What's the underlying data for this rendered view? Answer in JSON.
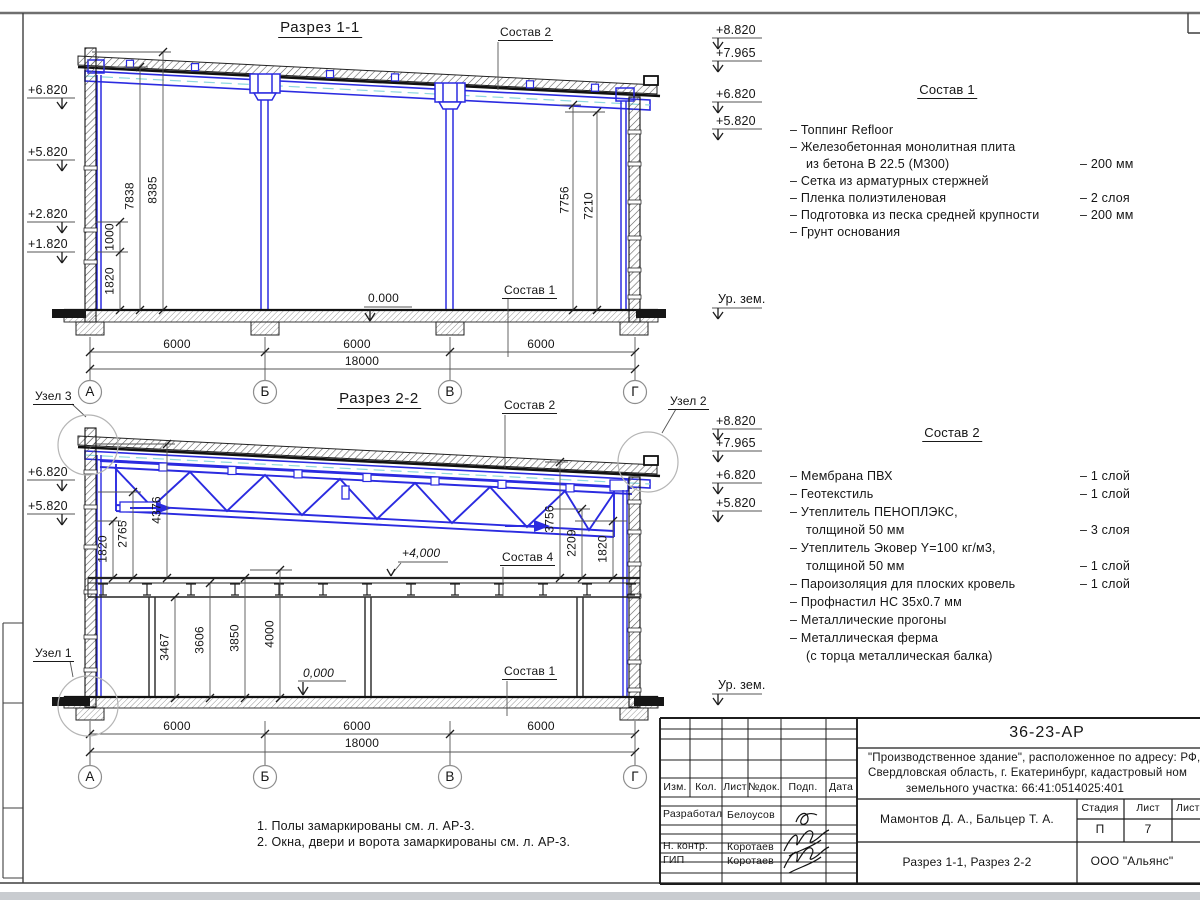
{
  "s1": {
    "title": "Разрез 1-1",
    "callout_top": "Состав 2",
    "callout_bottom": "Состав 1",
    "zero": "0.000",
    "elev_left": [
      "+6.820",
      "+5.820",
      "+2.820",
      "+1.820"
    ],
    "elev_right": [
      "+8.820",
      "+7.965",
      "+6.820",
      "+5.820"
    ],
    "ground": "Ур. зем.",
    "dims_v_left": [
      "1820",
      "1000",
      "7838",
      "8385"
    ],
    "dims_v_right": [
      "7756",
      "7210"
    ],
    "dims_bottom": [
      "6000",
      "6000",
      "6000"
    ],
    "dim_total": "18000",
    "grid": [
      "А",
      "Б",
      "В",
      "Г"
    ]
  },
  "s2": {
    "title": "Разрез 2-2",
    "callout_top": "Состав 2",
    "callout_mid": "Состав 4",
    "callout_bottom": "Состав 1",
    "level_mark": "+4,000",
    "zero": "0,000",
    "elev_left": [
      "+6.820",
      "+5.820"
    ],
    "elev_right": [
      "+8.820",
      "+7.965",
      "+6.820",
      "+5.820"
    ],
    "ground": "Ур. зем.",
    "dims_v_left": [
      "1820",
      "2765",
      "4376"
    ],
    "dims_v_right": [
      "3756",
      "2209",
      "1820"
    ],
    "dims_mezz": [
      "3467",
      "3606",
      "3850",
      "4000"
    ],
    "dims_bottom": [
      "6000",
      "6000",
      "6000"
    ],
    "dim_total": "18000",
    "grid": [
      "А",
      "Б",
      "В",
      "Г"
    ],
    "node1": "Узел 1",
    "node2": "Узел 2",
    "node3": "Узел 3"
  },
  "comp1": {
    "title": "Состав 1",
    "rows": [
      {
        "t": "– Топпинг Refloor",
        "v": ""
      },
      {
        "t": "– Железобетонная  монолитная плита",
        "v": ""
      },
      {
        "t": "из бетона В 22.5 (М300)",
        "v": "– 200 мм"
      },
      {
        "t": "– Сетка из арматурных стержней",
        "v": ""
      },
      {
        "t": "– Пленка полиэтиленовая",
        "v": "– 2 слоя"
      },
      {
        "t": "– Подготовка из песка средней крупности",
        "v": "– 200 мм"
      },
      {
        "t": "– Грунт основания",
        "v": ""
      }
    ]
  },
  "comp2": {
    "title": "Состав 2",
    "rows": [
      {
        "t": "– Мембрана ПВХ",
        "v": "– 1 слой"
      },
      {
        "t": "– Геотекстиль",
        "v": "– 1 слой"
      },
      {
        "t": "– Утеплитель ПЕНОПЛЭКС,",
        "v": ""
      },
      {
        "t": "толщиной 50 мм",
        "v": "– 3 слоя"
      },
      {
        "t": "– Утеплитель Эковер Y=100 кг/м3,",
        "v": ""
      },
      {
        "t": "толщиной 50 мм",
        "v": "– 1 слой"
      },
      {
        "t": "– Пароизоляция для плоских кровель",
        "v": "– 1 слой"
      },
      {
        "t": "– Профнастил НС 35х0.7 мм",
        "v": ""
      },
      {
        "t": "– Металлические прогоны",
        "v": ""
      },
      {
        "t": "– Металлическая ферма",
        "v": ""
      },
      {
        "t": "(с торца металлическая балка)",
        "v": ""
      }
    ]
  },
  "notes": [
    "1. Полы замаркированы см. л. АР-3.",
    "2. Окна, двери и ворота замаркированы см. л. АР-3."
  ],
  "tb": {
    "doc": "36-23-АР",
    "desc1": "\"Производственное здание\", расположенное по адресу: РФ,",
    "desc2": "Свердловская область, г. Екатеринбург, кадастровый ном",
    "desc3": "земельного участка: 66:41:0514025:401",
    "authors": "Мамонтов Д. А., Бальцер Т. А.",
    "sheet_title": "Разрез 1-1, Разрез 2-2",
    "org": "ООО \"Альянс\"",
    "stage_h": "Стадия",
    "sheet_h": "Лист",
    "sheets_h": "Листов",
    "stage": "П",
    "sheet": "7",
    "cols": [
      "Изм.",
      "Кол.",
      "Лист",
      "№док.",
      "Подп.",
      "Дата"
    ],
    "r1l": "Разработал",
    "r1n": "Белоусов",
    "r2l": "Н. контр.",
    "r2n": "Коротаев",
    "r3l": "ГИП",
    "r3n": "Коротаев"
  }
}
